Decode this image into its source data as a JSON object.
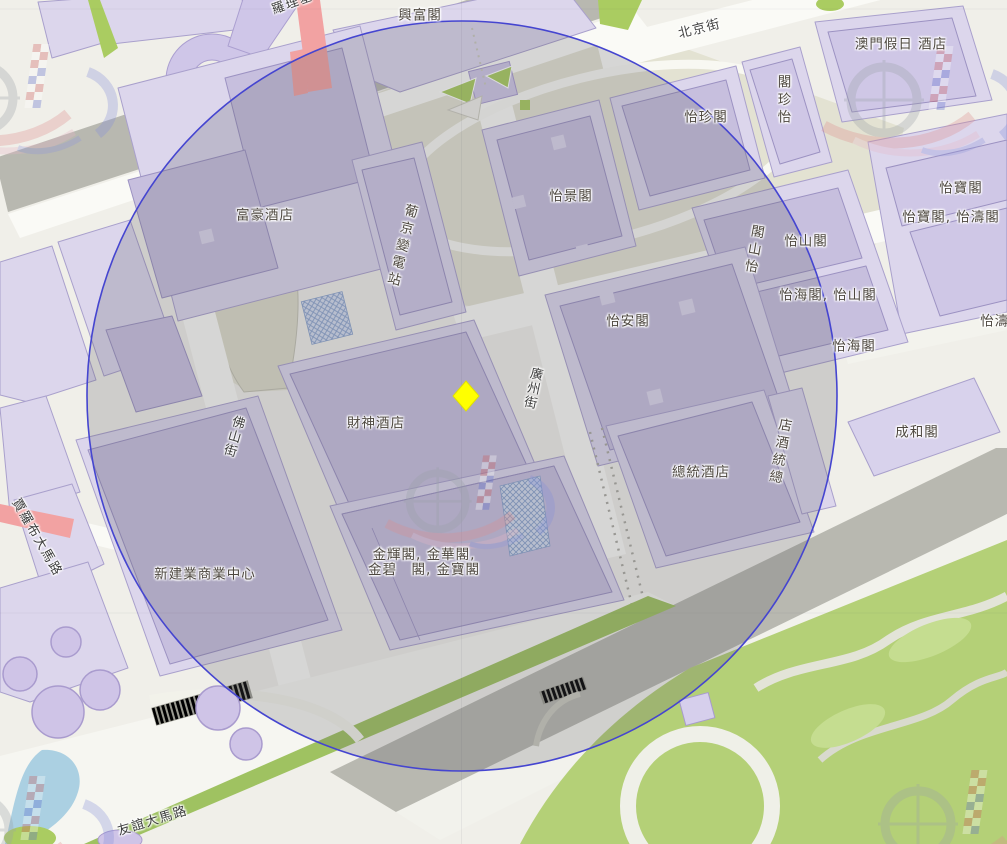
{
  "map": {
    "description": "Street map of the Macau NAPE district with a circular radius overlay and a yellow diamond marker on the Fortune Hotel block",
    "overlay_circle": {
      "stroke_color": "#4545d0",
      "fill_color": "rgba(88,86,94,0.22)"
    },
    "marker": {
      "shape": "diamond",
      "color": "#ffff00",
      "location_hint": "east corner of 財神酒店 building beside 廣州街"
    },
    "watermark": {
      "description": "map-provider logo: checkered flag column, grey ring, red and blue swooshes",
      "instances": 5
    },
    "labels": [
      {
        "text": "興富閣",
        "display": "興富閣",
        "category": "building",
        "orientation": "horizontal"
      },
      {
        "text": "北京街",
        "display": "北京街",
        "category": "street",
        "orientation": "rotated"
      },
      {
        "text": "澳門假日 酒店",
        "display": "澳門假日 酒店",
        "category": "hotel",
        "orientation": "horizontal"
      },
      {
        "text": "怡珍閣",
        "display": "怡珍閣",
        "category": "building",
        "orientation": "horizontal"
      },
      {
        "text": "怡珍閣",
        "display": "閣珍怡",
        "category": "building",
        "orientation": "vertical-bottom-up"
      },
      {
        "text": "富豪酒店",
        "display": "富豪酒店",
        "category": "hotel",
        "orientation": "horizontal"
      },
      {
        "text": "葡京變電站",
        "display": "葡京變電站",
        "category": "building",
        "orientation": "vertical"
      },
      {
        "text": "怡景閣",
        "display": "怡景閣",
        "category": "building",
        "orientation": "horizontal"
      },
      {
        "text": "怡山閣",
        "display": "怡山閣",
        "category": "building",
        "orientation": "horizontal"
      },
      {
        "text": "怡山閣",
        "display": "閣山怡",
        "category": "building",
        "orientation": "vertical-bottom-up"
      },
      {
        "text": "怡寶閣",
        "display": "怡寶閣",
        "category": "building",
        "orientation": "horizontal"
      },
      {
        "text": "怡寶閣, 怡濤閣",
        "display": "怡寶閣, 怡濤閣",
        "category": "building",
        "orientation": "horizontal"
      },
      {
        "text": "怡海閣, 怡山閣",
        "display": "怡海閣, 怡山閣",
        "category": "building",
        "orientation": "horizontal"
      },
      {
        "text": "怡海閣",
        "display": "怡海閣",
        "category": "building",
        "orientation": "horizontal"
      },
      {
        "text": "怡濤閣",
        "display": "怡濤閣",
        "category": "building",
        "orientation": "horizontal-clipped"
      },
      {
        "text": "怡安閣",
        "display": "怡安閣",
        "category": "building",
        "orientation": "horizontal"
      },
      {
        "text": "成和閣",
        "display": "成和閣",
        "category": "building",
        "orientation": "horizontal"
      },
      {
        "text": "財神酒店",
        "display": "財神酒店",
        "category": "hotel",
        "orientation": "horizontal"
      },
      {
        "text": "廣州街",
        "display": "廣州街",
        "category": "street",
        "orientation": "vertical"
      },
      {
        "text": "佛山街",
        "display": "佛山街",
        "category": "street",
        "orientation": "vertical"
      },
      {
        "text": "總統酒店",
        "display": "總統酒店",
        "category": "hotel",
        "orientation": "horizontal"
      },
      {
        "text": "總統酒店",
        "display": "店酒統總",
        "category": "hotel",
        "orientation": "vertical-bottom-up"
      },
      {
        "text": "新建業商業中心",
        "display": "新建業商業中心",
        "category": "building",
        "orientation": "horizontal"
      },
      {
        "text": "金輝閣, 金華閣, 金碧閣, 金寶閣",
        "display": "金輝閣, 金華閣,\n金碧　閣, 金寶閣",
        "category": "building",
        "orientation": "horizontal-two-line"
      },
      {
        "text": "賈羅布大馬路",
        "display": "賈羅布大馬路",
        "category": "street",
        "orientation": "rotated"
      },
      {
        "text": "友誼大馬路",
        "display": "友誼大馬路",
        "category": "street",
        "orientation": "rotated"
      },
      {
        "text": "羅理基",
        "display": "羅理基",
        "category": "street",
        "orientation": "rotated-clipped"
      }
    ],
    "colors": {
      "land": "#f0efe9",
      "building_lot": "#dcd6ec",
      "building": "#c7bfde",
      "building_outline": "#9c92c2",
      "road_white": "#fafaf6",
      "road_grey": "#b8b8b0",
      "highlight_road_pink": "#f2a2a2",
      "green_lawn": "#b4d077",
      "green_strip": "#9fc261",
      "water": "#abd0e2",
      "block_interior_olive": "#e3e2d2",
      "tree_purple": "#cfc4e7",
      "circle_stroke": "#4545d0",
      "marker_yellow": "#ffff00",
      "label_text": "#4d473f"
    }
  }
}
